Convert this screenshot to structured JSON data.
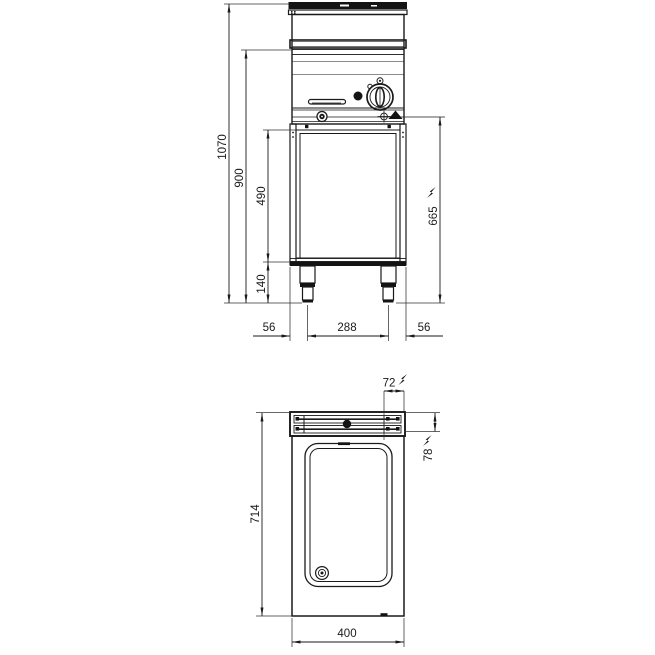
{
  "colors": {
    "line": "#1a1a1a",
    "background": "#ffffff"
  },
  "icons": {
    "electric_bolt": "lightning-bolt",
    "electric_connection": "circle-cross-with-filled-triangle",
    "control_knob": "round-control-knob",
    "indicator_light": "filled-round-dot",
    "screw": "ringed-screw-head",
    "drain": "concentric-circles"
  },
  "front_view": {
    "dimensions": {
      "total_height": "1070",
      "worktop_height": "900",
      "compartment_height": "490",
      "leg_height": "140",
      "electric_connection_height": "665",
      "left_edge_to_leg": "56",
      "leg_spacing": "288",
      "leg_to_right_edge": "56"
    }
  },
  "plan_view": {
    "dimensions": {
      "depth": "714",
      "width": "400",
      "electric_connection_from_right": "72",
      "electric_connection_from_back": "78"
    }
  }
}
